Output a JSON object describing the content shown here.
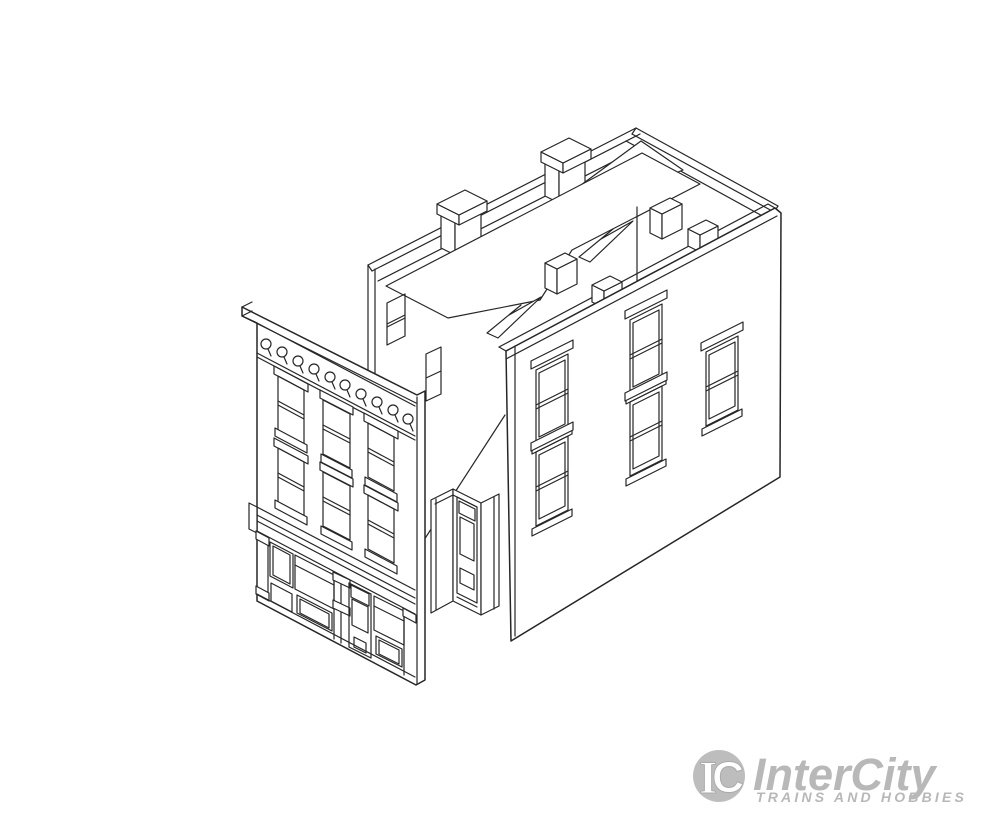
{
  "logo": {
    "brand": "InterCity",
    "tagline": "TRAINS AND HOBBIES",
    "monogram_i": "I",
    "monogram_c": "C"
  },
  "colors": {
    "bg": "#ffffff",
    "line": "#262626",
    "wm": "#b7b8b7",
    "wm-light": "#c6c7c6"
  }
}
